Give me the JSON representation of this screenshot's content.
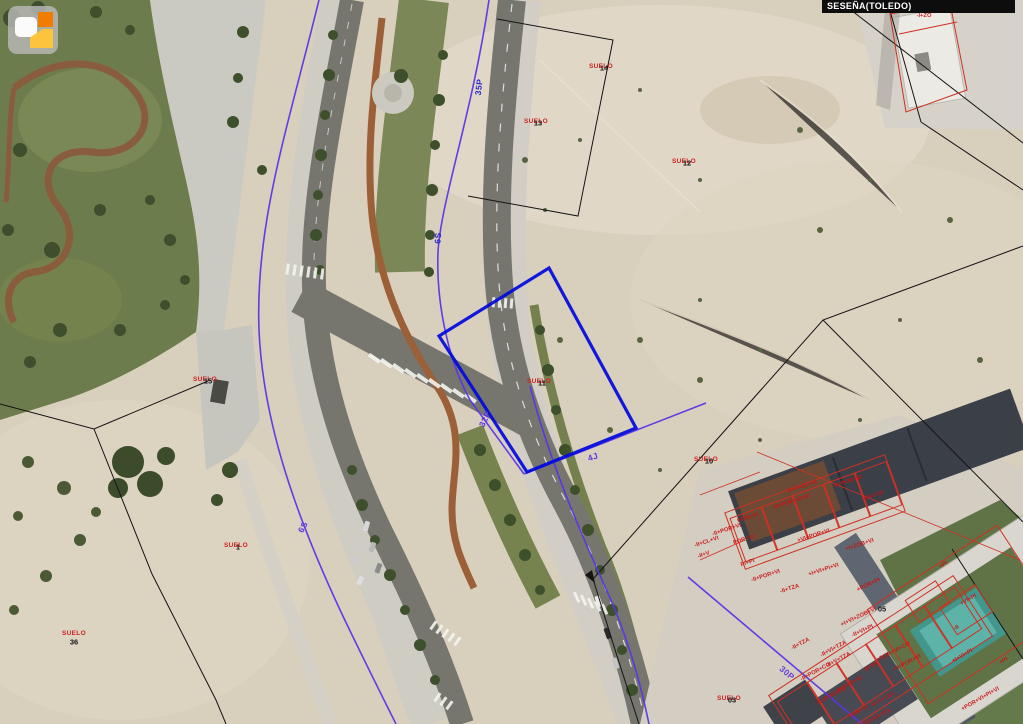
{
  "app": {
    "name": "cadastral-map-viewer"
  },
  "header": {
    "municipality_label": "SESEÑA(TOLEDO)"
  },
  "logo": {
    "icon": "catastro-layers-logo"
  },
  "colors": {
    "selected_parcel": "#0009dd",
    "urban_boundary": "#5a35e6",
    "cadastral_line": "#141414",
    "construction_label": "#cc1111",
    "suelo_label": "#cc2222",
    "parcel_number": "#141414",
    "municipality_bar": "#0d0d0d"
  },
  "map": {
    "boundary_labels": [
      {
        "text": "35P",
        "x": 479,
        "y": 87,
        "rot": -83,
        "color": "#2b2bd0"
      },
      {
        "text": "6S",
        "x": 438,
        "y": 238,
        "rot": -86,
        "color": "#2b2bd0"
      },
      {
        "text": "32P",
        "x": 485,
        "y": 419,
        "rot": -65,
        "color": "#5a35e6"
      },
      {
        "text": "4J",
        "x": 593,
        "y": 457,
        "rot": -18,
        "color": "#5a35e6"
      },
      {
        "text": "6S",
        "x": 303,
        "y": 527,
        "rot": -62,
        "color": "#5a35e6"
      },
      {
        "text": "30P",
        "x": 787,
        "y": 673,
        "rot": 40,
        "color": "#6a3fd8"
      }
    ],
    "suelo_labels": [
      {
        "text": "SUELO",
        "x": 601,
        "y": 67
      },
      {
        "text": "SUELO",
        "x": 536,
        "y": 122
      },
      {
        "text": "SUELO",
        "x": 684,
        "y": 162
      },
      {
        "text": "SUELO",
        "x": 539,
        "y": 382
      },
      {
        "text": "SUELO",
        "x": 706,
        "y": 460
      },
      {
        "text": "SUELO",
        "x": 205,
        "y": 380
      },
      {
        "text": "SUELO",
        "x": 236,
        "y": 546
      },
      {
        "text": "SUELO",
        "x": 74,
        "y": 634
      },
      {
        "text": "SUELO",
        "x": 729,
        "y": 699
      }
    ],
    "parcel_numbers": [
      {
        "text": "14",
        "x": 604,
        "y": 68
      },
      {
        "text": "13",
        "x": 538,
        "y": 123
      },
      {
        "text": "12",
        "x": 687,
        "y": 163
      },
      {
        "text": "11",
        "x": 542,
        "y": 383
      },
      {
        "text": "10",
        "x": 709,
        "y": 461
      },
      {
        "text": "15",
        "x": 208,
        "y": 381
      },
      {
        "text": "1",
        "x": 238,
        "y": 547
      },
      {
        "text": "36",
        "x": 74,
        "y": 642
      },
      {
        "text": "05",
        "x": 882,
        "y": 609
      },
      {
        "text": "03",
        "x": 732,
        "y": 700
      }
    ],
    "construction_labels": [
      {
        "text": "-I+ZO",
        "x": 924,
        "y": 17,
        "rot": 0
      },
      {
        "text": "-II+V+CL+VI",
        "x": 802,
        "y": 488,
        "rot": -18
      },
      {
        "text": "-II+POR+VI",
        "x": 848,
        "y": 483,
        "rot": -18
      },
      {
        "text": "-II+V+VI",
        "x": 874,
        "y": 497,
        "rot": -18
      },
      {
        "text": "-II+POR+VI+VI",
        "x": 792,
        "y": 503,
        "rot": -18
      },
      {
        "text": "POR+VI",
        "x": 748,
        "y": 519,
        "rot": -18
      },
      {
        "text": "-II+POR+VI",
        "x": 727,
        "y": 531,
        "rot": -18
      },
      {
        "text": "-II+CL+VI",
        "x": 707,
        "y": 543,
        "rot": -18
      },
      {
        "text": "POR+VI",
        "x": 744,
        "y": 541,
        "rot": -18
      },
      {
        "text": "-II+V",
        "x": 704,
        "y": 556,
        "rot": -18
      },
      {
        "text": "+VI+POR+VI",
        "x": 814,
        "y": 537,
        "rot": -18
      },
      {
        "text": "+I+ZOB+VI",
        "x": 860,
        "y": 546,
        "rot": -18
      },
      {
        "text": "PI+PI",
        "x": 748,
        "y": 564,
        "rot": -18
      },
      {
        "text": "-II+POR+VI",
        "x": 766,
        "y": 577,
        "rot": -18
      },
      {
        "text": "+I+VI+PI+VI",
        "x": 824,
        "y": 571,
        "rot": -18
      },
      {
        "text": "-II+TZA",
        "x": 790,
        "y": 590,
        "rot": -18
      },
      {
        "text": "+POR+PI",
        "x": 869,
        "y": 586,
        "rot": -25
      },
      {
        "text": "+I+VI+ZOB+VI",
        "x": 859,
        "y": 618,
        "rot": -25
      },
      {
        "text": "-II+VI+PI",
        "x": 863,
        "y": 632,
        "rot": -25
      },
      {
        "text": "+VI+PI",
        "x": 969,
        "y": 601,
        "rot": -30
      },
      {
        "text": "-II",
        "x": 957,
        "y": 629,
        "rot": -30
      },
      {
        "text": "+PI",
        "x": 944,
        "y": 566,
        "rot": -30
      },
      {
        "text": "-II+TZA",
        "x": 801,
        "y": 645,
        "rot": -28
      },
      {
        "text": "-II+VI+TZA",
        "x": 834,
        "y": 650,
        "rot": -28
      },
      {
        "text": "-II+V+TZA",
        "x": 839,
        "y": 661,
        "rot": -28
      },
      {
        "text": "-II+POR+CO",
        "x": 816,
        "y": 673,
        "rot": -28
      },
      {
        "text": "-II+VII",
        "x": 871,
        "y": 668,
        "rot": -28
      },
      {
        "text": "+POR+VI+CO",
        "x": 894,
        "y": 653,
        "rot": -28
      },
      {
        "text": "+I+POR+VI",
        "x": 908,
        "y": 664,
        "rot": -28
      },
      {
        "text": "-II+POR+VI",
        "x": 849,
        "y": 686,
        "rot": -28
      },
      {
        "text": "-II+POR+CO",
        "x": 832,
        "y": 697,
        "rot": -28
      },
      {
        "text": "-II+V+TZA",
        "x": 883,
        "y": 701,
        "rot": -28
      },
      {
        "text": "POR+VI",
        "x": 859,
        "y": 713,
        "rot": -28
      },
      {
        "text": "-II+VI+PI+TZA",
        "x": 875,
        "y": 720,
        "rot": -28
      },
      {
        "text": "+I+VI+PI",
        "x": 963,
        "y": 657,
        "rot": -30
      },
      {
        "text": "+PI",
        "x": 1004,
        "y": 662,
        "rot": -30
      },
      {
        "text": "+POR+VI+PI+VI",
        "x": 981,
        "y": 700,
        "rot": -30
      }
    ]
  }
}
